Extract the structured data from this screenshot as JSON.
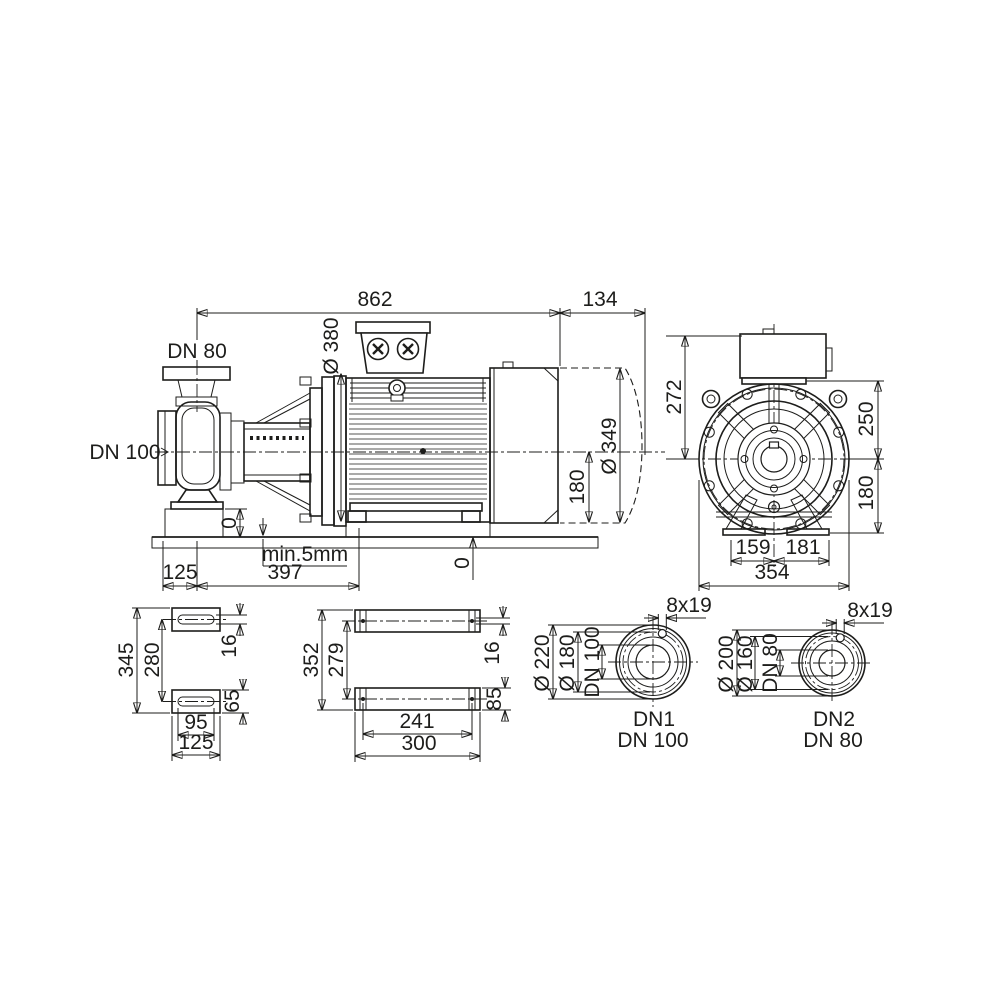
{
  "side_view": {
    "total_length": "862",
    "dismantling_space": "134",
    "discharge_label": "DN 80",
    "suction_label": "DN 100",
    "flange_od": "Ø 380",
    "motor_od": "Ø 349",
    "shaft_height": "180",
    "pump_foot_level": "0",
    "motor_foot_level": "0",
    "grout_note": "min.5mm",
    "foot_offset": "125",
    "foot_span": "397"
  },
  "end_view": {
    "box_to_axis": "272",
    "top_to_axis": "250",
    "axis_to_base": "180",
    "left_foot": "159",
    "right_foot": "181",
    "total_width": "354"
  },
  "pump_foot_plan": {
    "length_outer": "345",
    "slot_pitch": "280",
    "slot_width": "16",
    "foot_depth": "65",
    "slot_length": "95",
    "width_outer": "125"
  },
  "motor_foot_plan": {
    "length_outer": "352",
    "hole_pitch_y": "279",
    "hole_size": "16",
    "foot_depth": "85",
    "hole_pitch_x": "241",
    "width_outer": "300"
  },
  "flange_dn1": {
    "bolt_note": "8x19",
    "od": "Ø 220",
    "bolt_circle": "Ø 180",
    "nominal": "DN 100",
    "port_name": "DN1",
    "port_size": "DN 100"
  },
  "flange_dn2": {
    "bolt_note": "8x19",
    "od": "Ø 200",
    "bolt_circle": "Ø 160",
    "nominal": "DN 80",
    "port_name": "DN2",
    "port_size": "DN 80"
  },
  "colors": {
    "ink": "#1d1d1b",
    "paper": "#ffffff"
  }
}
